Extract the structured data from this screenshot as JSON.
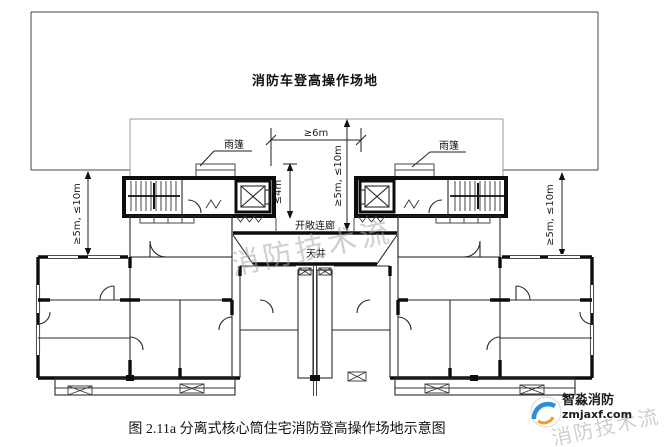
{
  "site": {
    "label": "消防车登高操作场地"
  },
  "dims": {
    "h6": "≥6m",
    "v5_10": "≥5m, ≤10m",
    "v4": "≤4m"
  },
  "plan": {
    "canopy": "雨篷",
    "corridor": "开敞连廊",
    "courtyard": "天井"
  },
  "caption": "图 2.11a 分离式核心筒住宅消防登高操作场地示意图",
  "watermark": {
    "stream": "消防技术流",
    "brand": "智淼消防",
    "url": "zmjaxf.com",
    "gray": "#a9a9a9",
    "blue": "#2b8fd0",
    "orange": "#f59a23"
  }
}
